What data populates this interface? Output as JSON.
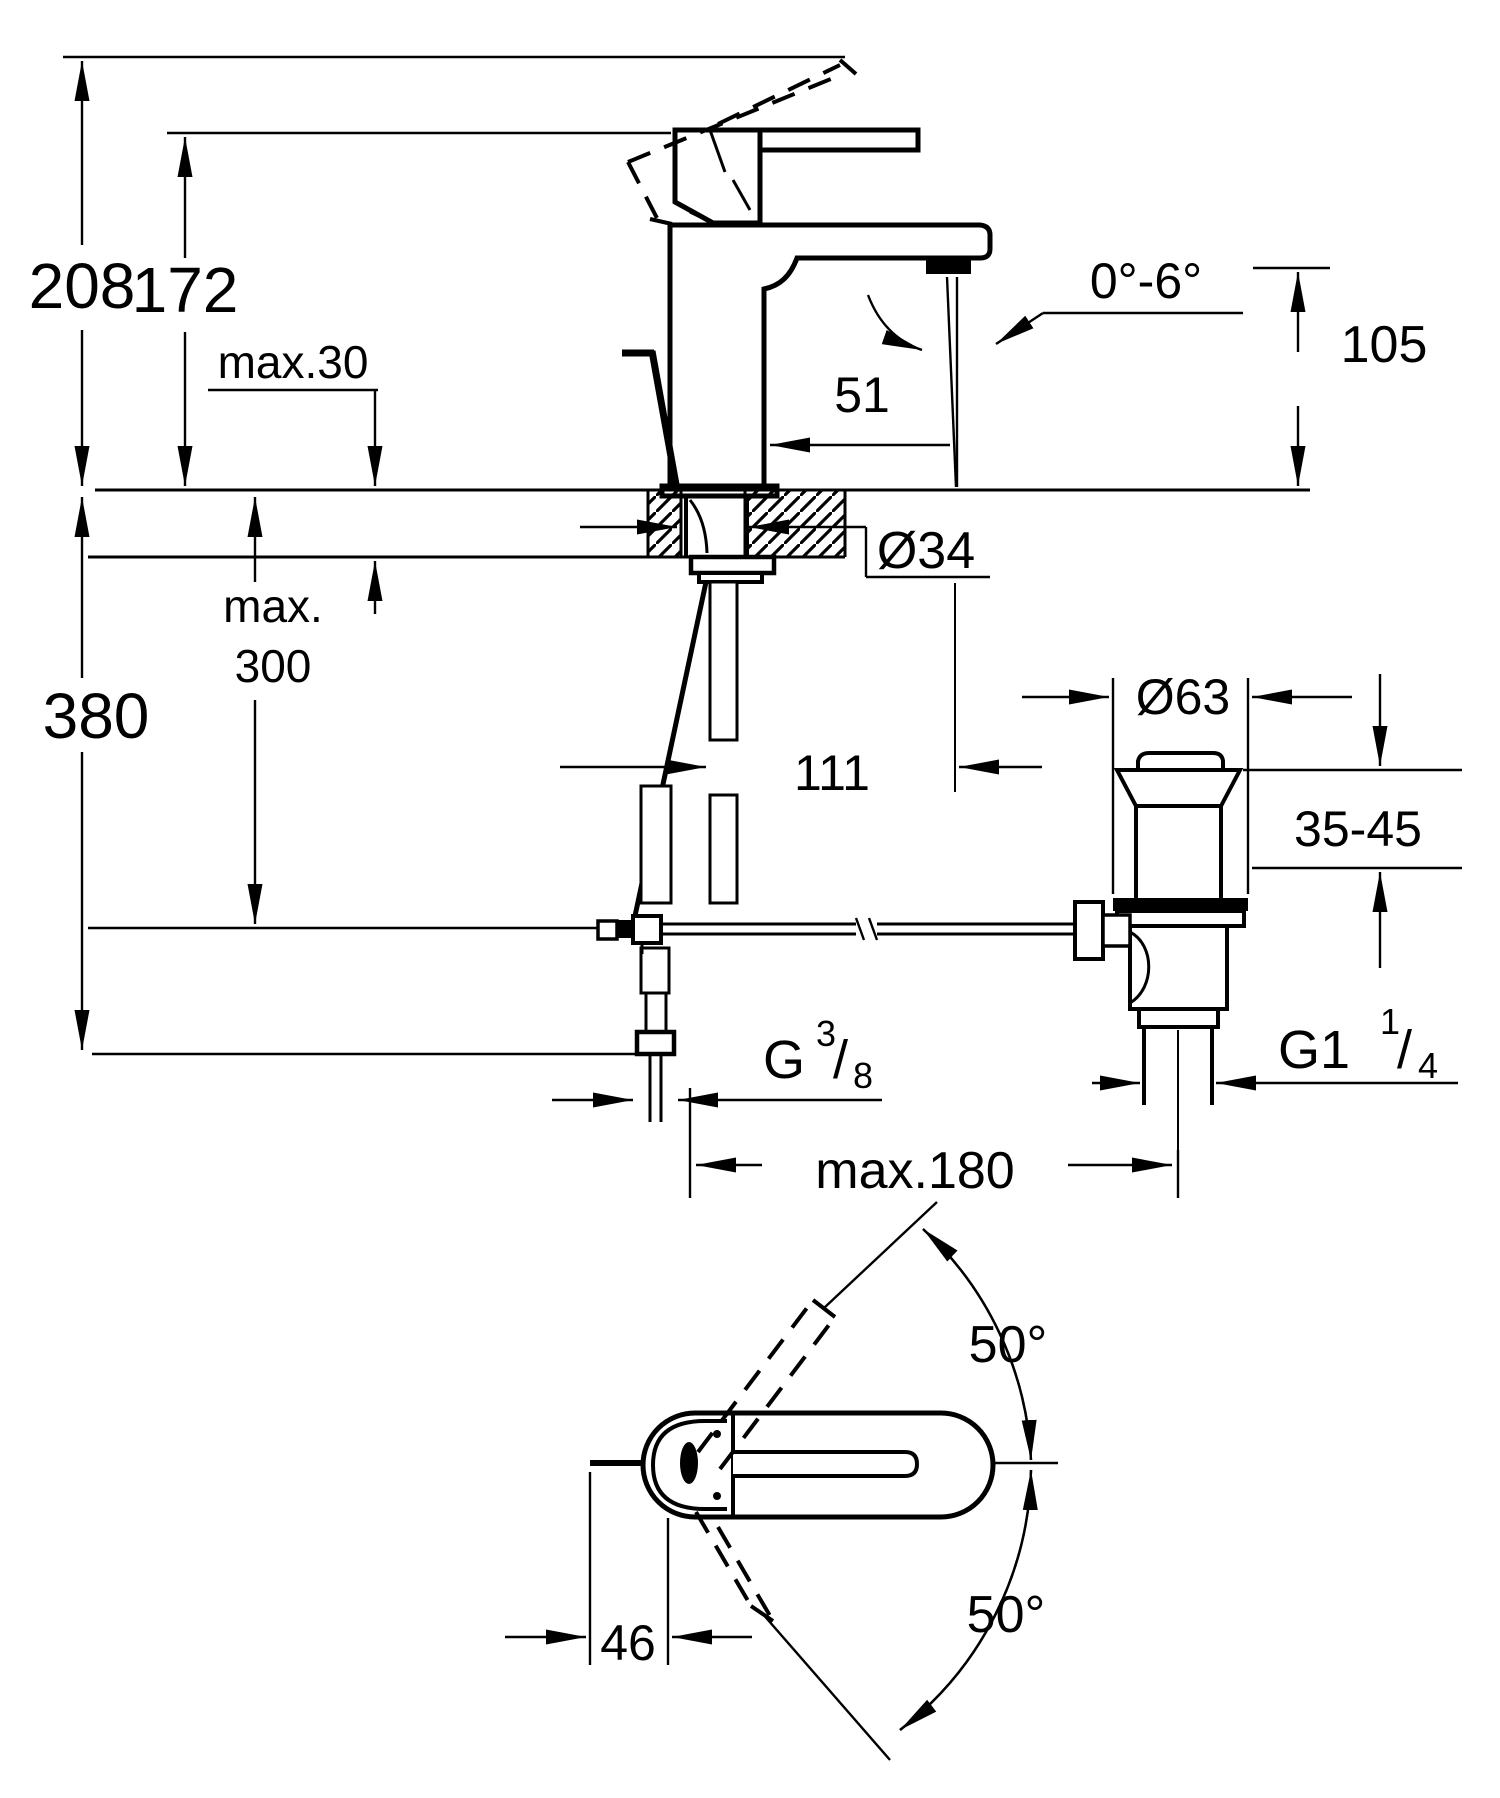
{
  "title": "Single-lever basin mixer — technical dimension drawing",
  "colors": {
    "line": "#000000",
    "background": "#ffffff"
  },
  "front_view": {
    "overall_height": "208",
    "height_to_lever": "172",
    "max_deck_thickness": "max.30",
    "spout_reach": "51",
    "outlet_angle_range": "0°-6°",
    "outlet_height": "105",
    "hole_diameter": "Ø34",
    "hose_depth_word": "max.",
    "hose_depth_value": "300",
    "overall_depth": "380",
    "axis_to_outlet": "111",
    "waste_flange_diameter": "Ø63",
    "waste_adjust_range": "35-45",
    "supply_thread": {
      "g": "G",
      "numerator": "3",
      "slash": "/",
      "denominator": "8"
    },
    "waste_thread": {
      "g": "G1",
      "numerator": "1",
      "slash": "/",
      "denominator": "4"
    },
    "rod_reach": "max.180"
  },
  "plan_view": {
    "swivel_up": "50°",
    "swivel_down": "50°",
    "rod_offset": "46"
  }
}
